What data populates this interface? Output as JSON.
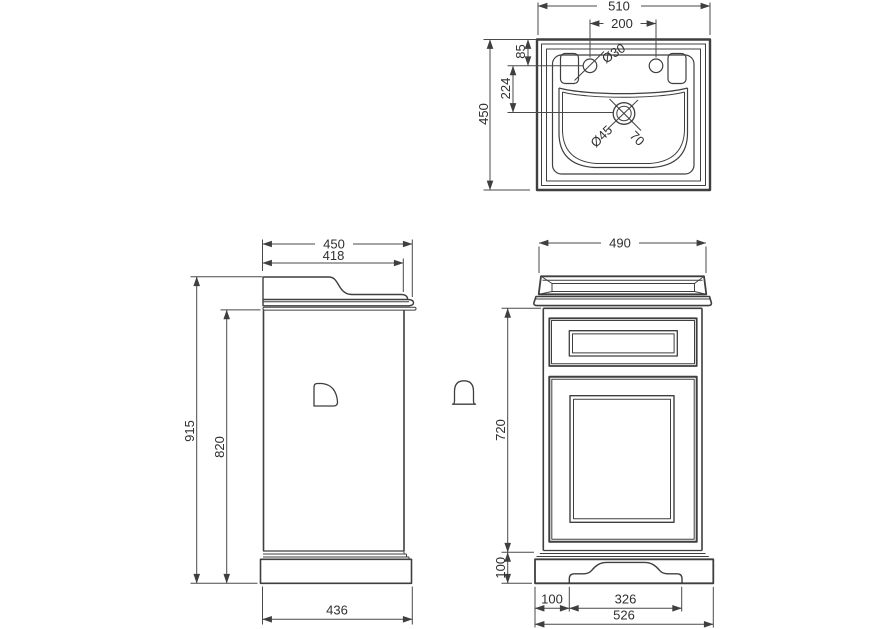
{
  "drawing": {
    "colors": {
      "line": "#3f3f3f",
      "text": "#2f2f2f",
      "background": "#ffffff"
    },
    "plan": {
      "overall_width": "510",
      "tap_hole_spacing": "200",
      "tap_hole_diameter": "Ø30",
      "rim_to_tap_holes": "85",
      "tap_holes_to_waste": "224",
      "overall_depth": "450",
      "waste_diameter": "Ø45",
      "waste_offset": "70"
    },
    "side": {
      "overall_depth": "450",
      "worktop_depth": "418",
      "overall_height": "915",
      "cabinet_height": "820",
      "base_depth": "436"
    },
    "front": {
      "overall_width": "490",
      "cabinet_height": "720",
      "plinth_height": "100",
      "plinth_side_width": "100",
      "arch_width": "326",
      "base_width": "526"
    }
  }
}
